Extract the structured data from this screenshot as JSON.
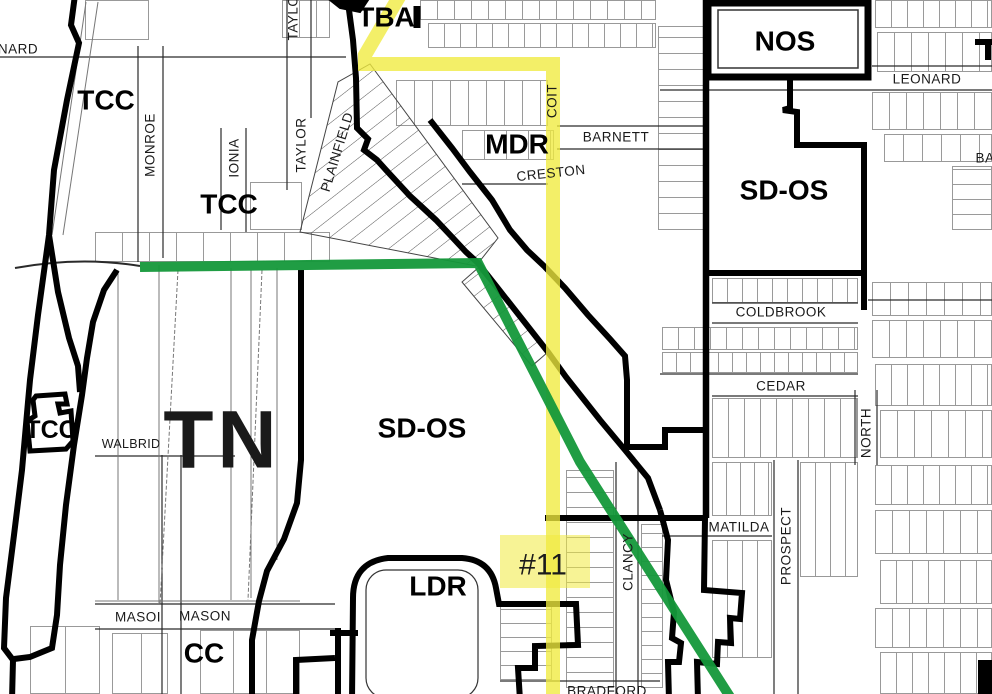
{
  "map": {
    "zones": {
      "tba": "TBA",
      "tcc_nw": "TCC",
      "tcc_mid": "TCC",
      "tcc_sw": "TCC",
      "nos": "NOS",
      "mdr": "MDR",
      "sd_os_east": "SD-OS",
      "sd_os_center": "SD-OS",
      "tn": "TN",
      "ldr": "LDR",
      "cc": "CC"
    },
    "streets": {
      "leonard_partial": "NARD",
      "monroe": "MONROE",
      "ionia": "IONIA",
      "taylor_partial": "TAYLO",
      "taylor": "TAYLOR",
      "plainfield": "PLAINFIELD",
      "coit": "COIT",
      "barnett": "BARNETT",
      "creston": "CRESTON",
      "leonard": "LEONARD",
      "barnett_partial": "BA",
      "coldbrook": "COLDBROOK",
      "cedar": "CEDAR",
      "north": "NORTH",
      "matilda": "MATILDA",
      "prospect": "PROSPECT",
      "walbridge_partial": "WALBRID",
      "mason_partial": "MASOI",
      "mason": "MASON",
      "clancy": "CLANCY",
      "bradford": "BRADFORD"
    },
    "marker": {
      "label": "#11"
    },
    "colors": {
      "route_yellow": "#f0ea3e",
      "route_green": "#14983a",
      "zone_gray_label": "#b4b4b4",
      "boundary_black": "#000000",
      "parcel_gray": "#999999"
    }
  }
}
